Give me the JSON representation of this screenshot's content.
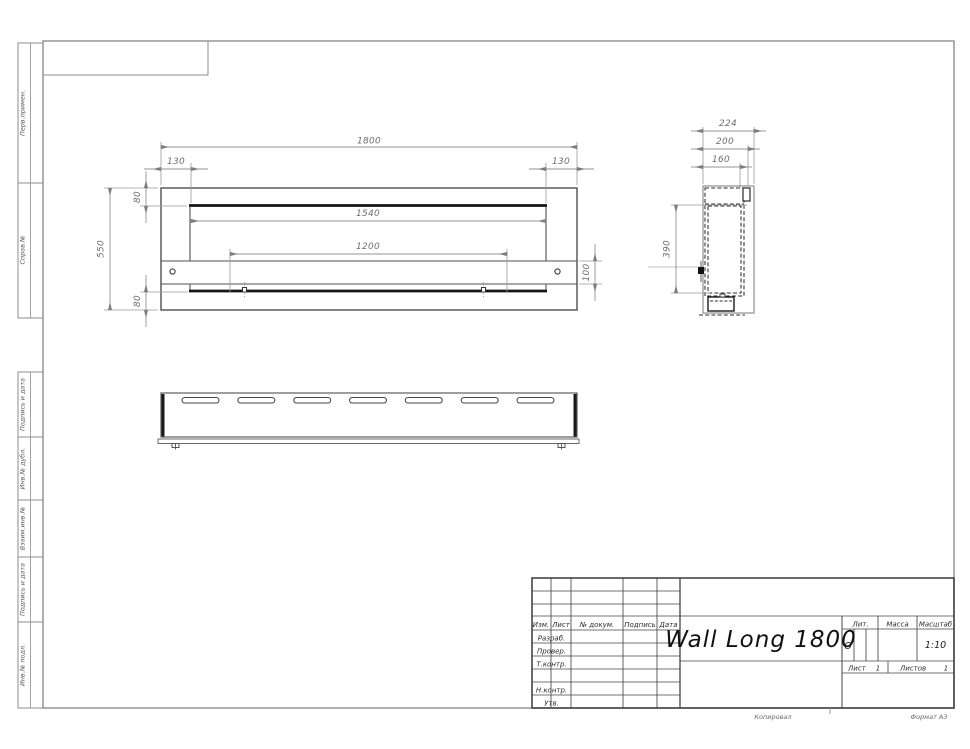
{
  "sheet": {
    "copy_note": "Копировал",
    "format_note": "Формат А3",
    "margin_labels": [
      "Перв.примен.",
      "Справ.№",
      "Подпись и дата",
      "Инв.№ дубл.",
      "Взаим.инв.№",
      "Подпись и дата",
      "Инв.№ подл."
    ]
  },
  "title_block": {
    "drawing_title": "Wall Long 1800",
    "header_cols": [
      "Изм.",
      "Лист",
      "№ докум.",
      "Подпись",
      "Дата"
    ],
    "signature_rows": [
      "Разраб.",
      "Провер.",
      "Т.контр.",
      "Н.контр.",
      "Утв."
    ],
    "liter": {
      "label": "Лит.",
      "value": "О"
    },
    "mass": {
      "label": "Масса",
      "value": ""
    },
    "scale": {
      "label": "Масштаб",
      "value": "1:10"
    },
    "sheet_no": {
      "label": "Лист",
      "value": "1"
    },
    "sheets_total": {
      "label": "Листов",
      "value": "1"
    }
  },
  "dims": {
    "front": {
      "overall_width": "1800",
      "left_inset": "130",
      "right_inset": "130",
      "top_flange": "80",
      "bottom_flange": "80",
      "overall_height": "550",
      "inner_width": "1540",
      "slot_width": "1200",
      "band_height": "100"
    },
    "side": {
      "overall_depth": "224",
      "mid_depth": "200",
      "top_opening": "160",
      "insert_height": "390"
    }
  },
  "colors": {
    "frame_gray": "#8d8d8d",
    "object_line": "#4f4f4f",
    "main_line_dark": "#151515",
    "dimension_gray": "#939393",
    "text_dark": "#1c1c1c"
  }
}
